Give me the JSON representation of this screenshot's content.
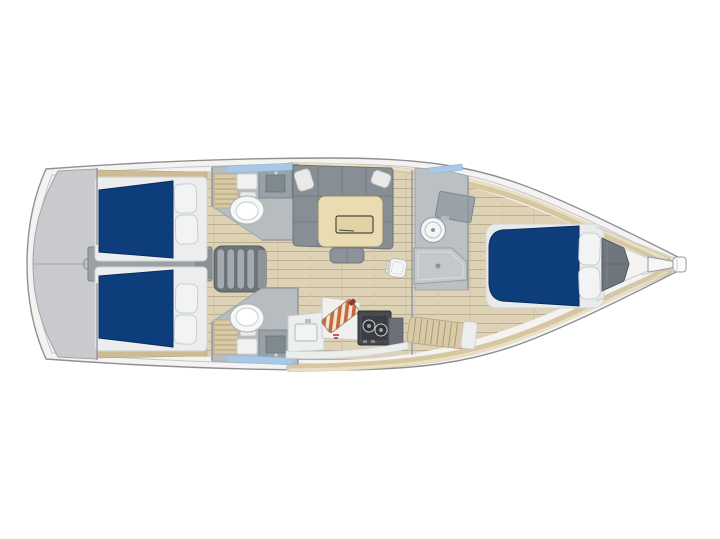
{
  "boat": {
    "view": "top-down interior floor plan",
    "orientation": "bow to the right, stern to the left",
    "description": "Sailboat interior layout plan, top view: swim platform astern, two aft double cabins with navy mattresses, central engine compartment and companionway steps, port and starboard aft heads with toilet and sink, salon with U-shaped settee and table, galley with sink, cutting board and two-burner stove, forward head with round basin and shower pan, forward V-berth cabin with navy mattress and two pillows, anchor locker and bowsprit at the bow."
  },
  "colors": {
    "canvas_bg": "#ffffff",
    "hull_fill": "#f4f3f1",
    "hull_line": "#8f9094",
    "deck_wood": "#d6c7a1",
    "floor_wood": "#ddd1b6",
    "floor_plank_line": "#b9aa8c",
    "mattress_navy": "#0e3d7c",
    "pillow_white": "#f2f3f4",
    "transom_gray": "#c9cacd",
    "engine_gray": "#9aa0a5",
    "steps_gray": "#6d747a",
    "tread_gray": "#a3aab0",
    "settee_gray": "#878e94",
    "table_cream": "#eadcb0",
    "table_recess": "#e3d3a2",
    "head_floor": "#b7bcc1",
    "sink_gray": "#99a2a8",
    "counter_white": "#edefef",
    "stove_dark": "#45494e",
    "board_orange": "#c9683a",
    "slat_wood": "#d8caa6",
    "trim_wood": "#cdbb96",
    "locker_gray": "#70767e",
    "window_blue": "#a9c8e5",
    "red_mark": "#cc2222"
  },
  "regions": [
    {
      "id": "swim-platform",
      "label": "Swim platform / transom"
    },
    {
      "id": "aft-cabin-starboard",
      "label": "Aft double cabin (top)"
    },
    {
      "id": "aft-cabin-port",
      "label": "Aft double cabin (bottom)"
    },
    {
      "id": "engine-compartment",
      "label": "Engine compartment"
    },
    {
      "id": "companionway-steps",
      "label": "Companionway steps"
    },
    {
      "id": "aft-head-starboard",
      "label": "Aft head with toilet and sink (top)"
    },
    {
      "id": "aft-head-port",
      "label": "Aft head with toilet and sink (bottom)"
    },
    {
      "id": "salon",
      "label": "Salon with U-settee and table"
    },
    {
      "id": "galley",
      "label": "Galley with sink, cutting board and stove"
    },
    {
      "id": "forward-head",
      "label": "Forward head with basin and shower"
    },
    {
      "id": "forward-cabin",
      "label": "Forward V-berth cabin"
    },
    {
      "id": "anchor-locker",
      "label": "Anchor locker"
    },
    {
      "id": "bowsprit",
      "label": "Bowsprit"
    }
  ]
}
